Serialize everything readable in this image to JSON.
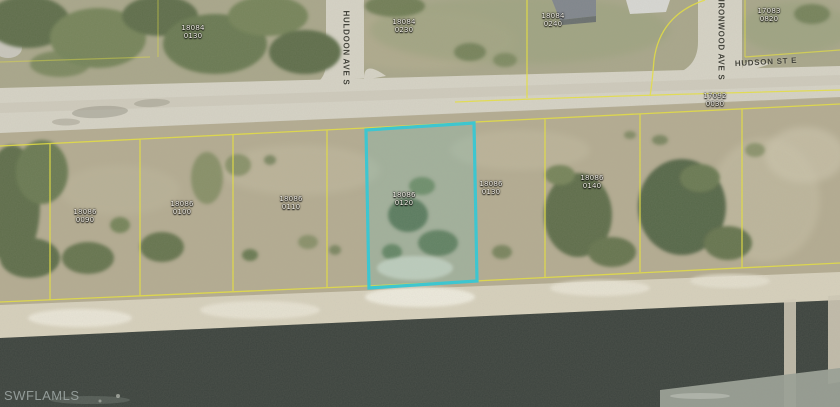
{
  "map": {
    "watermark": "SWFLAMLS",
    "streets": {
      "huldoon": "HULDOON AVE S",
      "ironwood": "IRONWOOD AVE S",
      "hudson": "HUDSON ST E"
    },
    "colors": {
      "highlight": "#35c8d4",
      "parcel_line": "#e8e23c",
      "water": "#3c433e",
      "road": "#d6d3c6",
      "terrain": "#b6af97"
    },
    "parcels": [
      {
        "book": "18084",
        "lot": "0130",
        "band": "north-of-road"
      },
      {
        "book": "18084",
        "lot": "0230",
        "band": "north-of-road"
      },
      {
        "book": "18084",
        "lot": "0240",
        "band": "north-of-road"
      },
      {
        "book": "17083",
        "lot": "0820",
        "band": "north-of-road"
      },
      {
        "book": "17092",
        "lot": "0030",
        "band": "east-block"
      },
      {
        "book": "18086",
        "lot": "0090",
        "band": "canal-block"
      },
      {
        "book": "18086",
        "lot": "0100",
        "band": "canal-block"
      },
      {
        "book": "18086",
        "lot": "0110",
        "band": "canal-block"
      },
      {
        "book": "18086",
        "lot": "0120",
        "band": "canal-block",
        "highlighted": true
      },
      {
        "book": "18086",
        "lot": "0130",
        "band": "canal-block"
      },
      {
        "book": "18086",
        "lot": "0140",
        "band": "canal-block"
      }
    ]
  }
}
